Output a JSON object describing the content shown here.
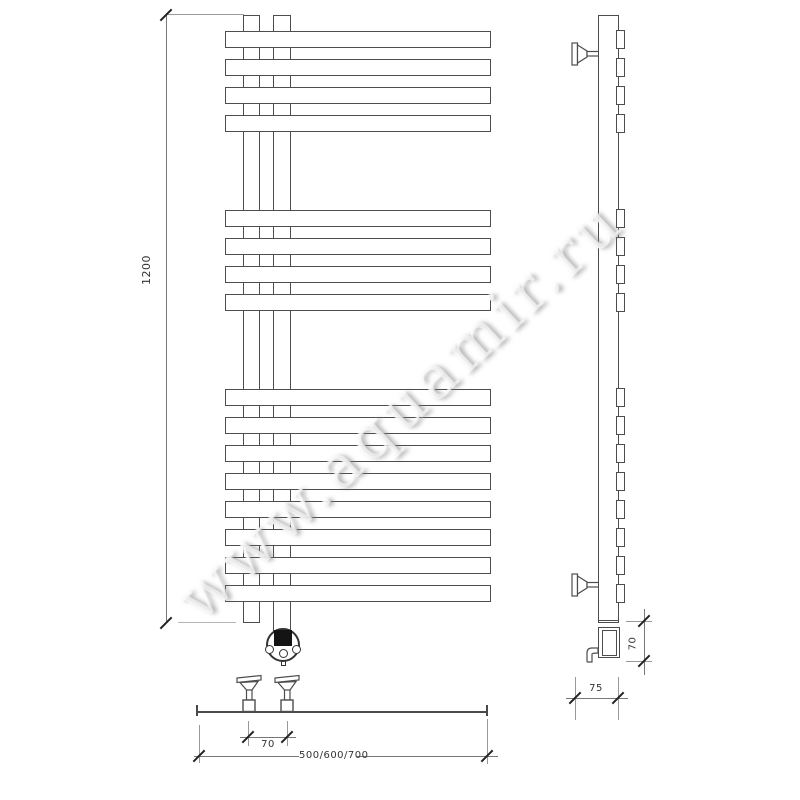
{
  "watermark": {
    "text": "www.aquamir.ru"
  },
  "drawing": {
    "subject": "towel-radiator-technical-drawing",
    "line_color": "#4d4d4d",
    "background": "#ffffff"
  },
  "dimensions": {
    "overall_height": "1200",
    "valve_spacing": "70",
    "overall_width": "500/600/700",
    "heater_height": "70",
    "depth": "75"
  }
}
